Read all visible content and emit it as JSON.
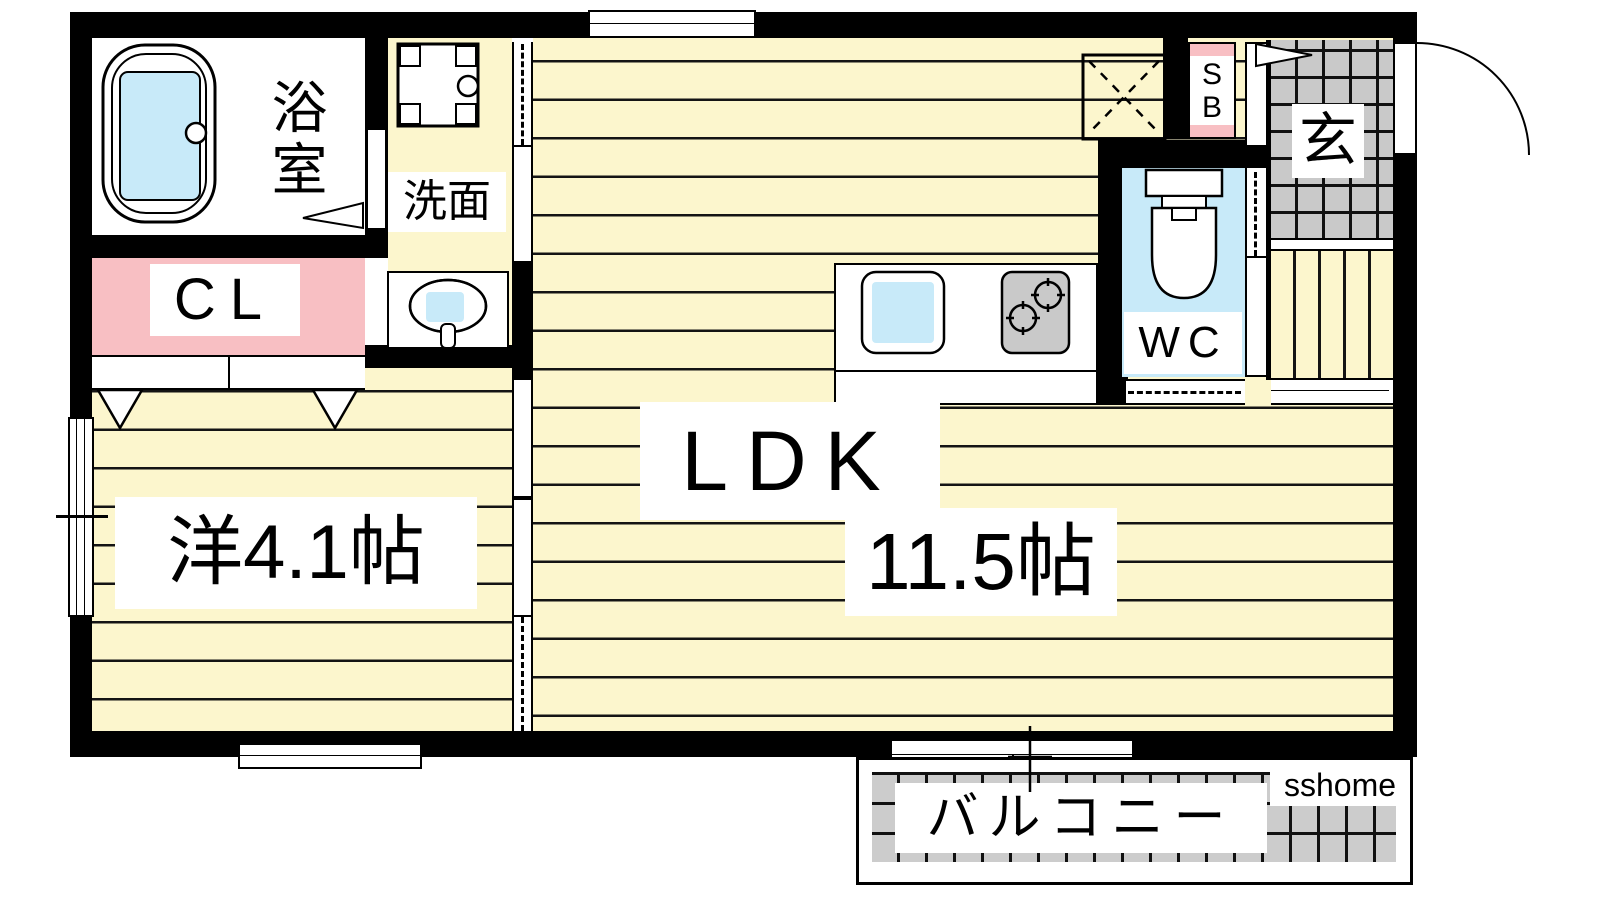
{
  "rooms": {
    "bathroom": {
      "label": "浴室"
    },
    "washroom": {
      "label": "洗面"
    },
    "closet": {
      "label": "CL"
    },
    "western_room": {
      "label": "洋4.1帖"
    },
    "ldk": {
      "label": "LDK",
      "size_label": "11.5帖"
    },
    "wc": {
      "label": "WC"
    },
    "shoe_box": {
      "line1": "S",
      "line2": "B"
    },
    "entrance": {
      "label": "玄"
    },
    "balcony": {
      "label": "バルコニー"
    }
  },
  "watermark": {
    "label": "sshome"
  },
  "fixtures": [
    "bathtub-icon",
    "washing-machine-pan-icon",
    "wash-basin-icon",
    "toilet-icon",
    "kitchen-sink-icon",
    "gas-stove-icon",
    "refrigerator-space-icon",
    "entrance-door-swing-icon",
    "closet-hanger-icon",
    "bathroom-door-icon"
  ],
  "colors": {
    "floor_yellow": "#FCF6CD",
    "accent_pink": "#F8BFC3",
    "water_blue": "#C8EAF9",
    "tile_gray": "#CBCBCB",
    "wall_black": "#000000"
  }
}
